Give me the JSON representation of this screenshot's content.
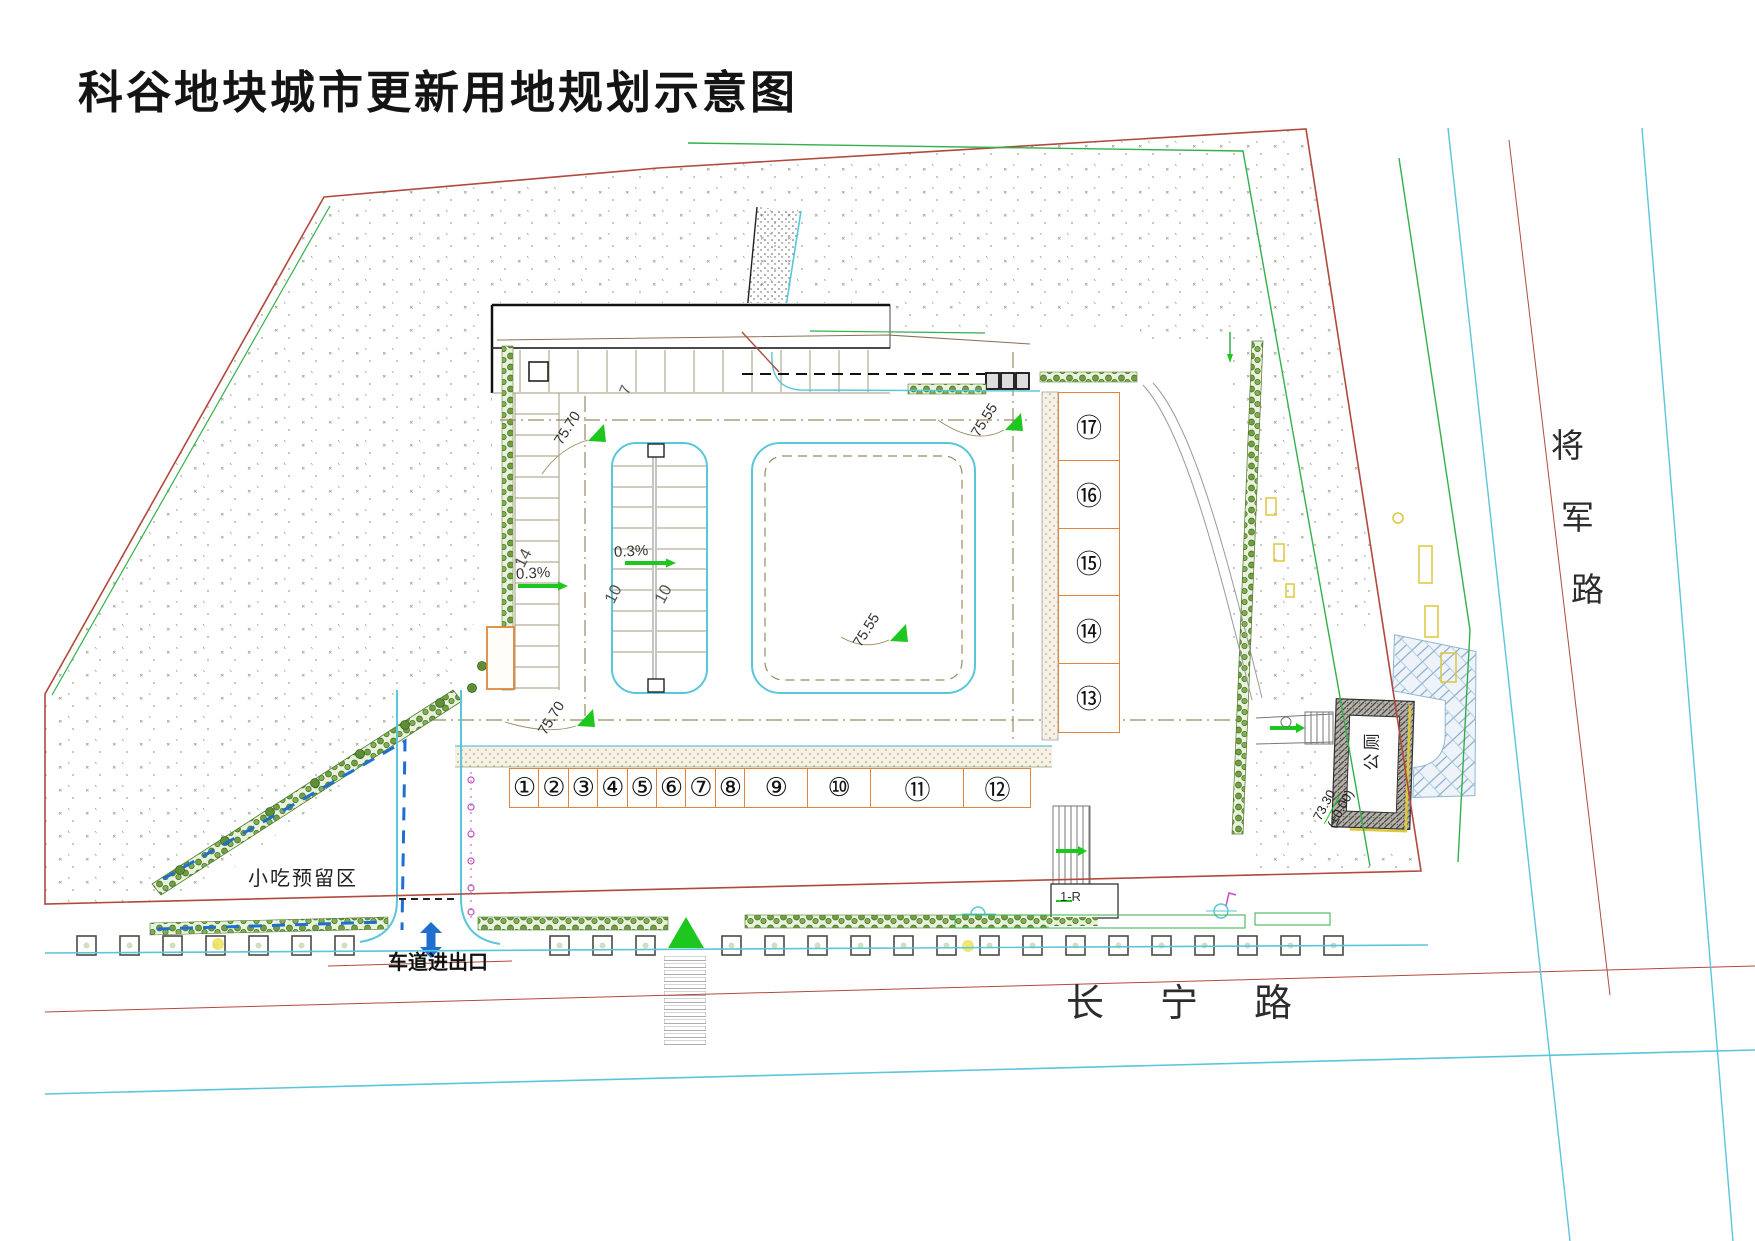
{
  "title": "科谷地块城市更新用地规划示意图",
  "roads": {
    "east": "将军路",
    "east_chars": [
      "将",
      "军",
      "路"
    ],
    "south": "长宁路"
  },
  "labels": {
    "snack_area": "小吃预留区",
    "driveway_entrance": "车道进出口",
    "public_toilet": "公厕",
    "building": "1-R"
  },
  "units": {
    "row": [
      "①",
      "②",
      "③",
      "④",
      "⑤",
      "⑥",
      "⑦",
      "⑧",
      "⑨",
      "⑩",
      "⑪",
      "⑫"
    ],
    "column": [
      "⑰",
      "⑯",
      "⑮",
      "⑭",
      "⑬"
    ]
  },
  "annotations": {
    "elevations": [
      {
        "value": "75.70",
        "loc": "north-aisle"
      },
      {
        "value": "75.70",
        "loc": "south-aisle"
      },
      {
        "value": "75.55",
        "loc": "northeast-aisle"
      },
      {
        "value": "75.55",
        "loc": "southeast-aisle"
      }
    ],
    "toilet_elevation": {
      "value": "73.30",
      "datum": "(±0.00)"
    },
    "slopes": [
      "0.3%",
      "0.3%"
    ],
    "stall_counts": {
      "west_row": "14",
      "island_left": "10",
      "island_right": "10",
      "north_row": "7"
    }
  },
  "colors": {
    "boundary_red": "#b2493d",
    "road_cyan": "#5ac6da",
    "green_line": "#33b04a",
    "hedge_green": "#4a7d2d",
    "unit_orange": "#e0863c",
    "dashed_blue": "#1e6fd0",
    "marker_green": "#1ec71e",
    "tan_line": "#9a8a60",
    "magenta": "#c050c0",
    "yellow": "#dcc83c",
    "paving_blue": "#7fa6c8"
  }
}
